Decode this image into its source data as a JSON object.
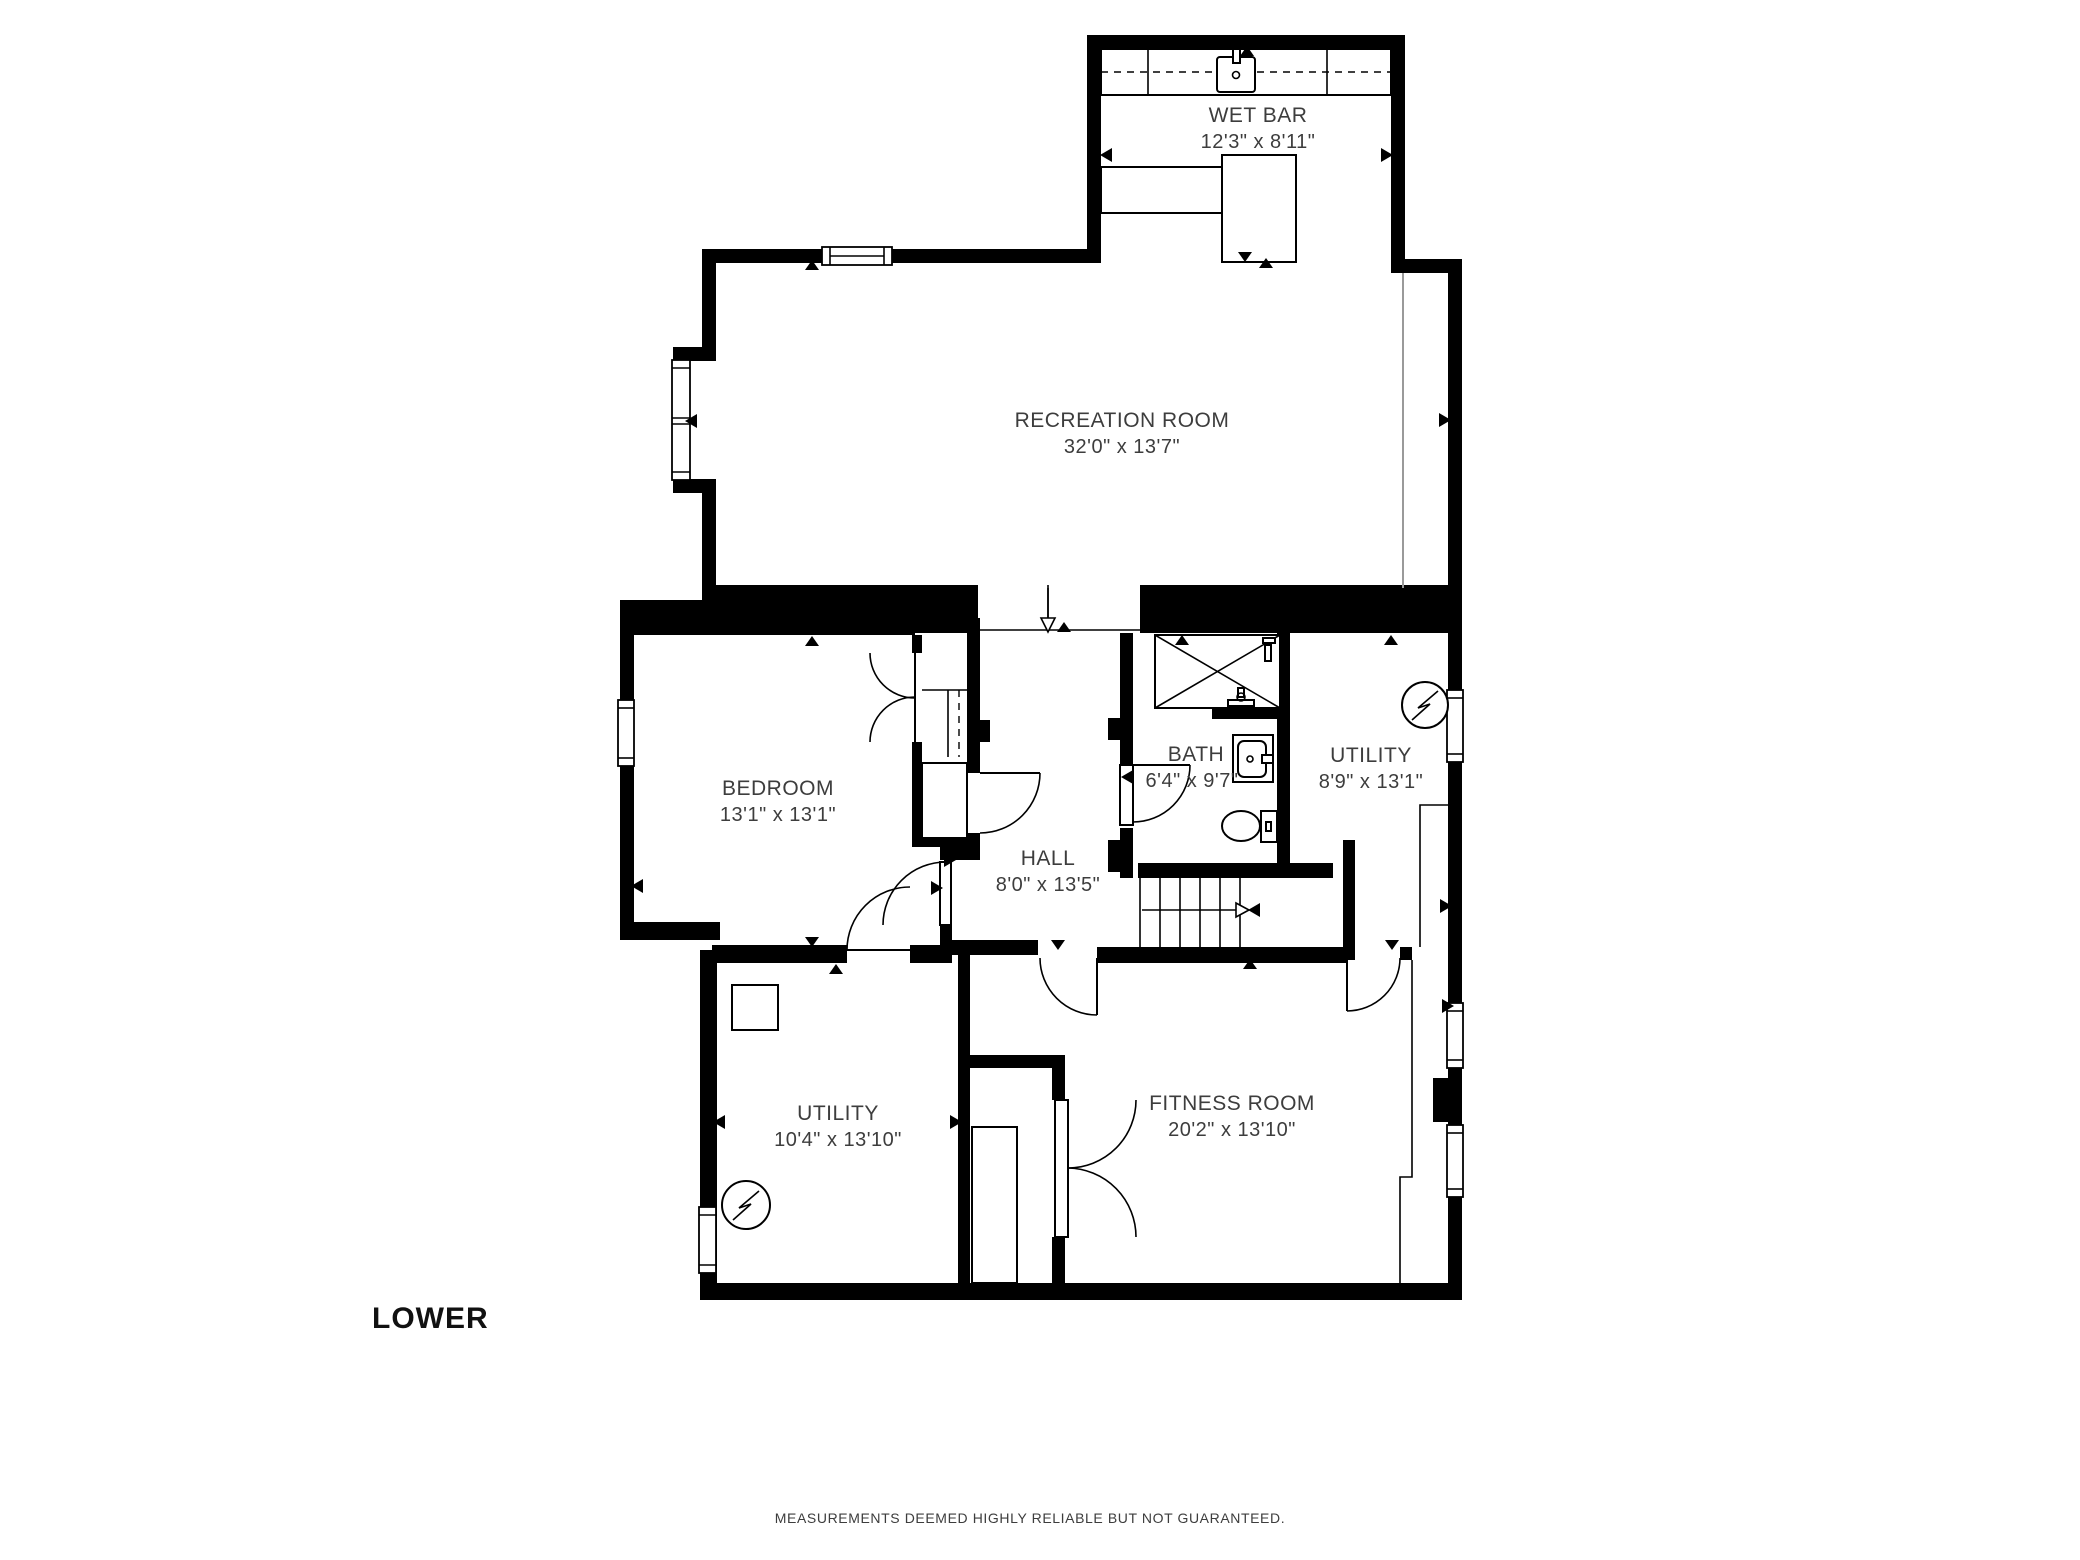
{
  "floor_label": "LOWER",
  "disclaimer": "MEASUREMENTS DEEMED HIGHLY RELIABLE BUT NOT GUARANTEED.",
  "colors": {
    "wall": "#000000",
    "background": "#ffffff",
    "label": "#3d3d3d"
  },
  "rooms": [
    {
      "key": "wet-bar",
      "name": "WET BAR",
      "dims": "12'3\" x 8'11\""
    },
    {
      "key": "recreation-room",
      "name": "RECREATION ROOM",
      "dims": "32'0\" x 13'7\""
    },
    {
      "key": "bedroom",
      "name": "BEDROOM",
      "dims": "13'1\" x 13'1\""
    },
    {
      "key": "bath",
      "name": "BATH",
      "dims": "6'4\" x 9'7\""
    },
    {
      "key": "utility-right",
      "name": "UTILITY",
      "dims": "8'9\" x 13'1\""
    },
    {
      "key": "hall",
      "name": "HALL",
      "dims": "8'0\" x 13'5\""
    },
    {
      "key": "utility-lower",
      "name": "UTILITY",
      "dims": "10'4\" x 13'10\""
    },
    {
      "key": "fitness-room",
      "name": "FITNESS ROOM",
      "dims": "20'2\" x 13'10\""
    }
  ]
}
